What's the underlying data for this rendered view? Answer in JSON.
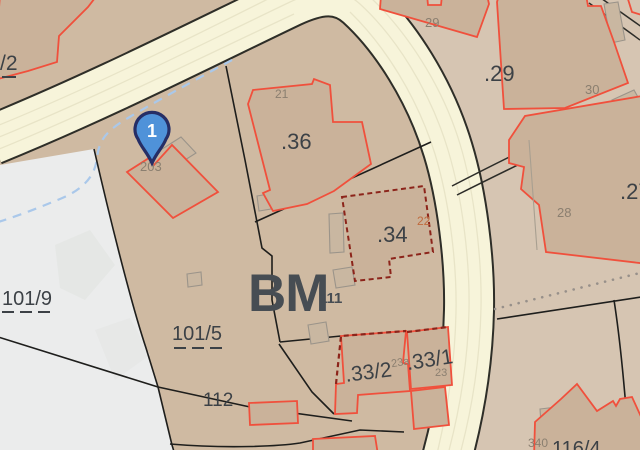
{
  "map": {
    "kind": "cadastral-parcel-map",
    "marker": {
      "number": "1",
      "fill": "#4f92d9",
      "border": "#262e66"
    },
    "labels": {
      "slash2": "/2",
      "p101_9": "101/9",
      "p101_5": "101/5",
      "p112": "112",
      "p116_4": "116/4",
      "bm": "BM",
      "n111": "111",
      "b203": "203",
      "b21": "21",
      "b22": "22",
      "b23a": "23a",
      "b23": "23",
      "b28": "28",
      "b29": "29",
      "b30": "30",
      "b340": "340",
      "d36": ".36",
      "d34": ".34",
      "d29": ".29",
      "d27": ".27",
      "d33_2": ".33/2",
      "d33_1": ".33/1"
    },
    "colors": {
      "parcel_tan": "#cfbaa2",
      "parcel_tan_light": "#d6c5b2",
      "unzoned_white": "#ebecec",
      "road_fill": "#f7f4da",
      "road_casing": "#2e2e28",
      "building_fill": "#cab29a",
      "building_stroke": "#f0503c",
      "building_stroke_dashed": "#8c241a",
      "boundary": "#1e1e1c",
      "stream_blue": "#aac8ea",
      "label_dark": "#3c4146",
      "label_gray": "#8b7f70",
      "label_orange": "#c06b3e",
      "bm_text": "#474d53"
    }
  }
}
